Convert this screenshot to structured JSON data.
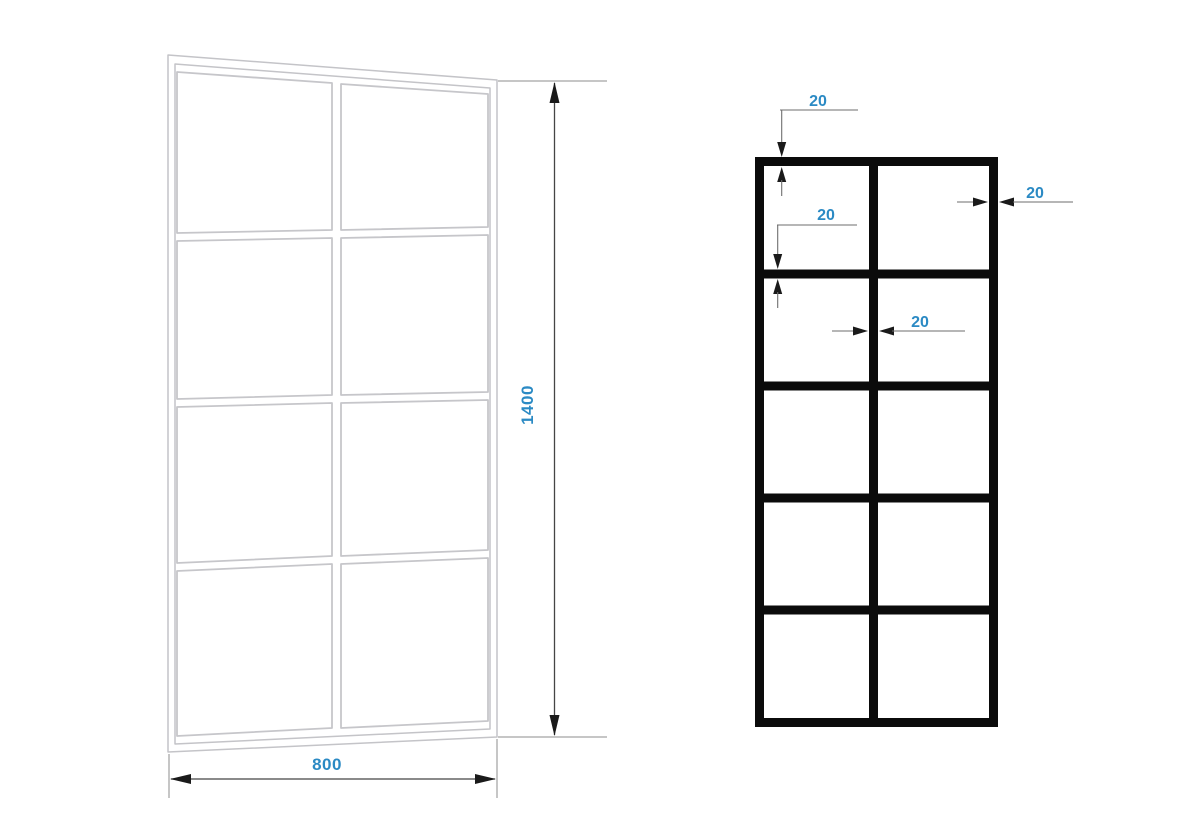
{
  "colors": {
    "background": "#ffffff",
    "dimension_label": "#2b8ac4",
    "panel_outline": "#c4c4c8",
    "grid_bar": "#0b0b0b",
    "dimension_line": "#454545",
    "extension_line": "#8d8d8d",
    "arrow": "#1a1a1a"
  },
  "left_drawing": {
    "type": "panel-perspective-view",
    "grid": {
      "columns": 2,
      "rows": 4
    },
    "height_label": "1400",
    "width_label": "800"
  },
  "right_drawing": {
    "type": "panel-elevation-grid",
    "grid": {
      "columns": 2,
      "rows": 5
    },
    "profile_labels": {
      "top_frame": "20",
      "horizontal_mullion": "20",
      "right_frame": "20",
      "vertical_mullion": "20"
    }
  }
}
